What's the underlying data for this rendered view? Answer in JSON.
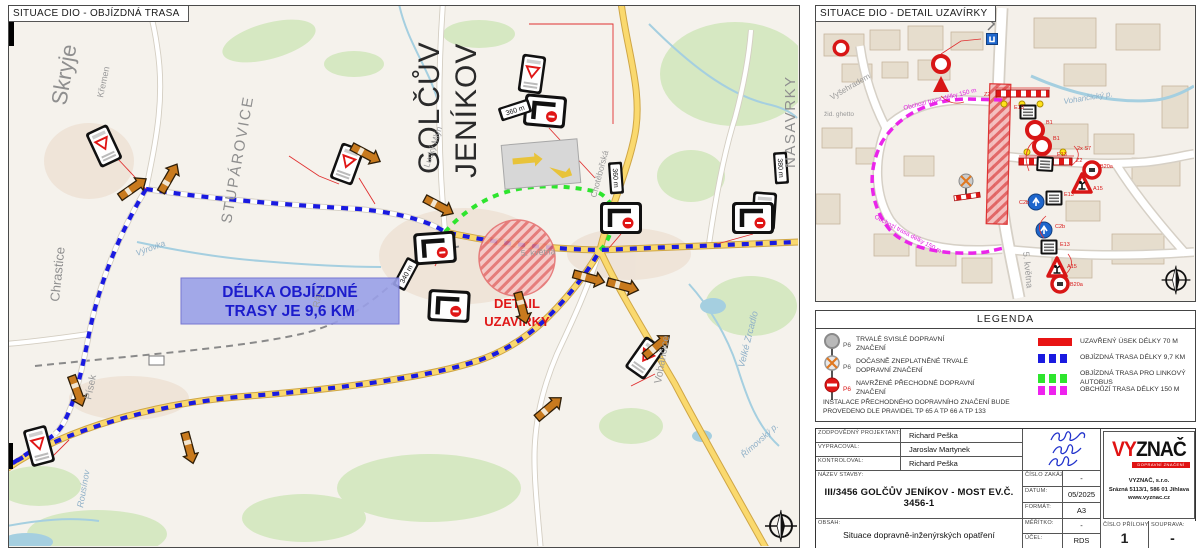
{
  "colors": {
    "closed_section": "#e81414",
    "detour_route": "#1a1ae0",
    "bus_detour_route": "#2ee52e",
    "walk_bypass_route": "#ee22ee",
    "detour_box_bg": "#9aa0e8",
    "detour_box_text": "#1c1ccc",
    "logo_red": "#e01212"
  },
  "left_map": {
    "title": "SITUACE DIO - OBJÍZDNÁ TRASA",
    "detour_box": {
      "line1": "DÉLKA OBJÍZDNÉ",
      "line2": "TRASY JE 9,6 KM"
    },
    "closure_label": {
      "line1": "DETAIL",
      "line2": "UZAVÍRKY"
    },
    "places": {
      "skryje": "Skryje",
      "kremen": "Křemen",
      "stuparovice": "STUPÁROVICE",
      "chrastice": "Chrastice",
      "golcuv": "GOLČŮV",
      "jenikov": "JENÍKOV",
      "nasavrky": "NASAVRKY",
      "pisek": "Písek",
      "rousinov": "Rousínov",
      "lucky_mlyn": "Lucký Mlýn",
      "choteborska": "Chotěbořská",
      "kvetna": "5. května",
      "vohancice": "Vohančice",
      "velke_zrcadlo": "Velké Zrcadlo",
      "vyrovka": "Výrovka",
      "raj": "Ráj",
      "rimovsky": "Římovský p."
    },
    "distance_signs": [
      "340 m",
      "360 m",
      "380 m",
      "360 m"
    ]
  },
  "right_map": {
    "title": "SITUACE DIO - DETAIL UZAVÍRKY",
    "streets": {
      "vysehradem": "Vyšehradem",
      "ghetto": "žid. ghetto",
      "kvetna": "5. května",
      "stream": "Vohančický p."
    },
    "route_labels": [
      "Obchozí trasa délky 150 m",
      "Obchozí trasa délky 150 m"
    ],
    "sign_codes": [
      "Z2",
      "E13",
      "B1",
      "B1",
      "E13",
      "Z2",
      "2x S7",
      "C2b",
      "E13",
      "A15",
      "B20a",
      "C2b",
      "E13",
      "A15",
      "B20a"
    ]
  },
  "legend": {
    "title": "LEGENDA",
    "sign_items": [
      {
        "code": "P6",
        "text": "TRVALÉ SVISLÉ DOPRAVNÍ ZNAČENÍ"
      },
      {
        "code": "P6",
        "text": "DOČASNĚ ZNEPLATNĚNÉ TRVALÉ DOPRAVNÍ ZNAČENÍ"
      },
      {
        "code": "P6",
        "text": "NAVRŽENÉ PŘECHODNÉ DOPRAVNÍ ZNAČENÍ"
      }
    ],
    "line_items": [
      {
        "color": "#e81414",
        "style": "solid",
        "text": "UZAVŘENÝ ÚSEK DÉLKY 70 M"
      },
      {
        "color": "#1a1ae0",
        "style": "dashed",
        "text": "OBJÍZDNÁ TRASA DÉLKY 9,7 KM"
      },
      {
        "color": "#2ee52e",
        "style": "dashed",
        "text": "OBJÍZDNÁ TRASA PRO LINKOVÝ AUTOBUS"
      },
      {
        "color": "#ee22ee",
        "style": "dashed",
        "text": "OBCHŮZÍ TRASA DÉLKY 150 M"
      }
    ],
    "note": "INSTALACE PŘECHODNÉHO DOPRAVNÍHO ZNAČENÍ BUDE PROVEDENO DLE PRAVIDEL TP 65 A TP 66 A TP 133"
  },
  "titleblock": {
    "people_rows": [
      {
        "label": "ZODPOVĚDNÝ PROJEKTANT:",
        "value": "Richard Peška"
      },
      {
        "label": "VYPRACOVAL:",
        "value": "Jaroslav Martynek"
      },
      {
        "label": "KONTROLOVAL:",
        "value": "Richard Peška"
      }
    ],
    "name_label": "NÁZEV STAVBY:",
    "name": "III/3456 GOLČŮV JENÍKOV - MOST EV.Č. 3456-1",
    "obsah_label": "OBSAH:",
    "obsah": "Situace dopravně-inženýrských opatření",
    "zakazka_label": "ČÍSLO ZAKÁZKY:",
    "zakazka": "-",
    "datum_label": "DATUM:",
    "datum": "05/2025",
    "format_label": "FORMÁT:",
    "format": "A3",
    "meritko_label": "MĚŘÍTKO:",
    "meritko": "-",
    "ucel_label": "ÚČEL:",
    "ucel": "RDS",
    "priloha_label": "ČÍSLO PŘÍLOHY:",
    "priloha": "1",
    "souprava_label": "SOUPRAVA:",
    "souprava": "-",
    "logo": {
      "vy": "VY",
      "znac": "ZNAČ",
      "tagline": "DOPRAVNÍ ZNAČENÍ",
      "company": "VYZNAČ, s.r.o.",
      "address": "Srázná 5113/1, 586 01 Jihlava",
      "web": "www.vyznac.cz"
    }
  }
}
